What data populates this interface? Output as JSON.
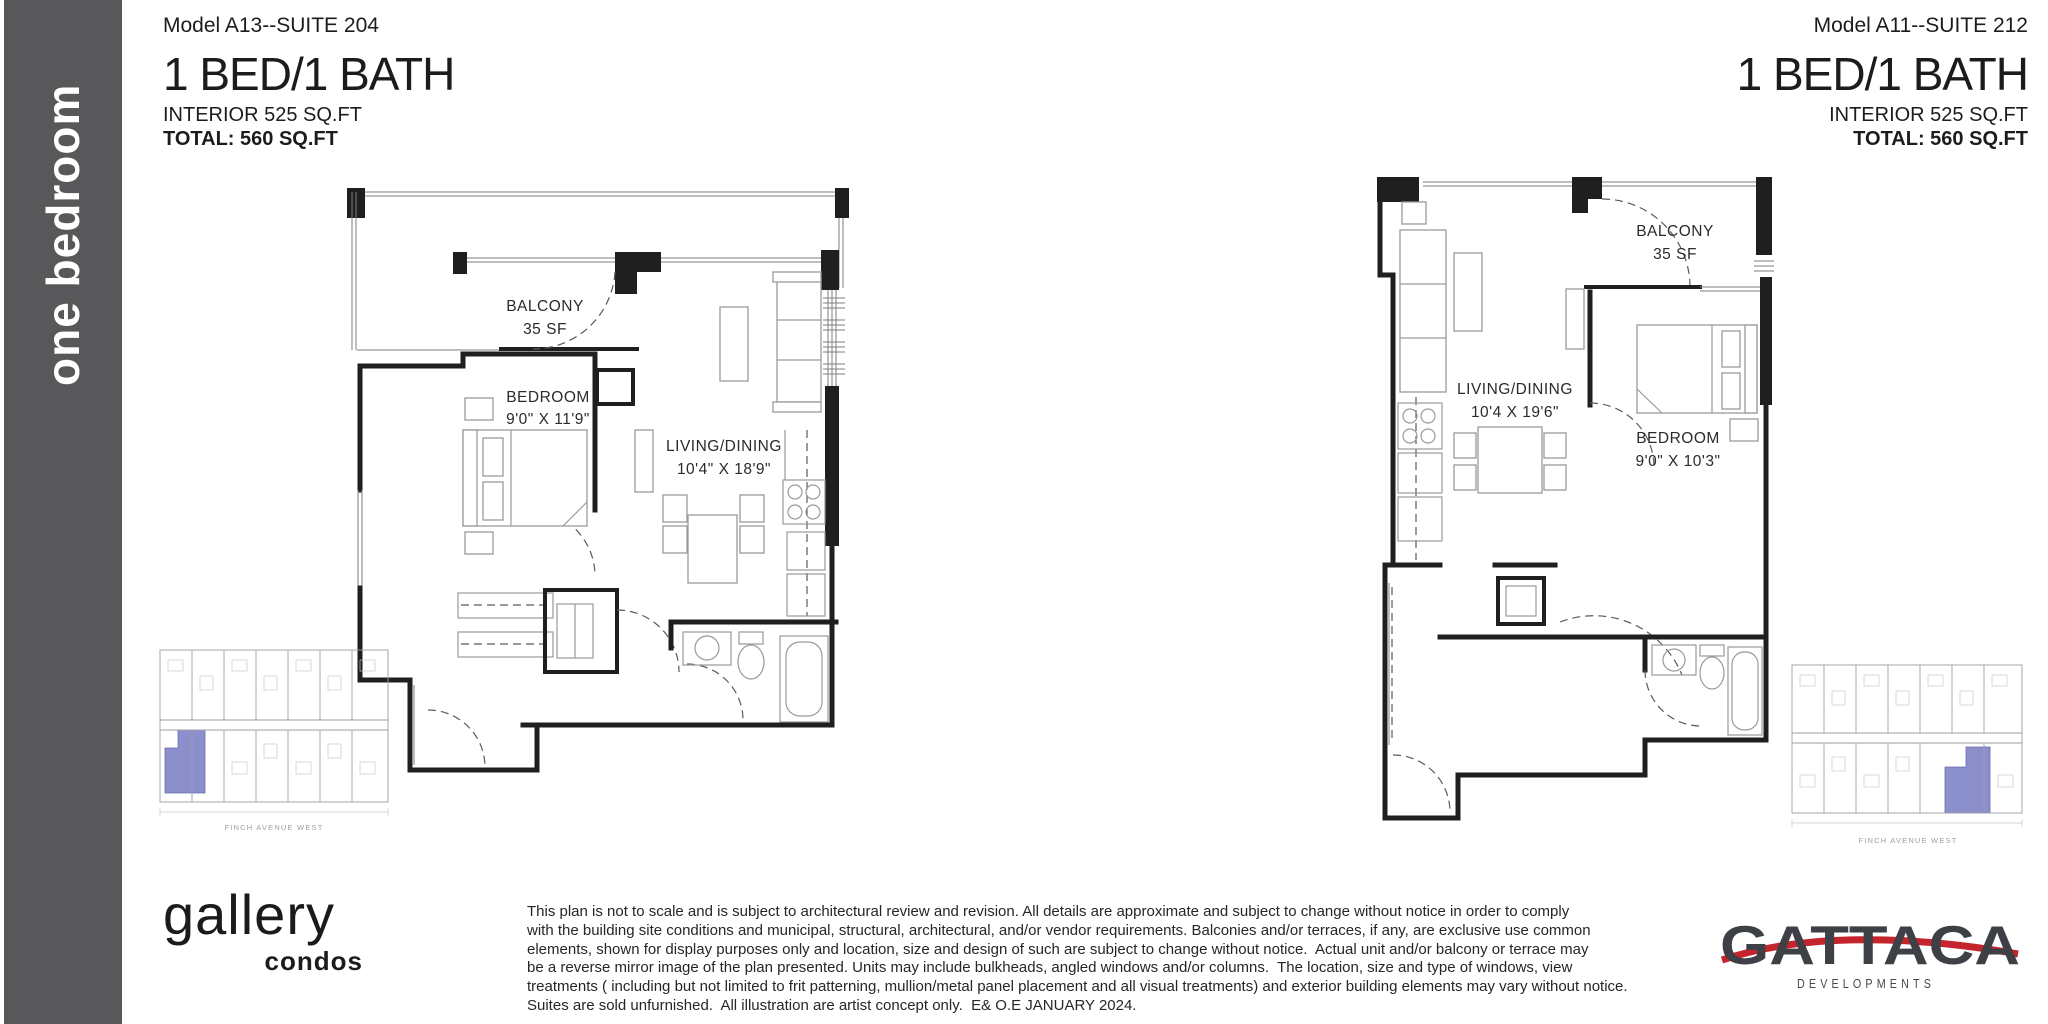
{
  "sidebar": {
    "label": "one bedroom"
  },
  "plans": [
    {
      "model": "Model A13--SUITE 204",
      "type": "1 BED/1 BATH",
      "interior": "INTERIOR 525 SQ.FT",
      "total": "TOTAL: 560 SQ.FT",
      "labels": {
        "balcony": "BALCONY",
        "balcony_area": "35 SF",
        "bedroom": "BEDROOM",
        "bedroom_dim": "9'0\" X 11'9\"",
        "living": "LIVING/DINING",
        "living_dim": "10'4\" X 18'9\""
      },
      "keyplan_caption": "FINCH AVENUE WEST"
    },
    {
      "model": "Model A11--SUITE 212",
      "type": "1 BED/1 BATH",
      "interior": "INTERIOR 525 SQ.FT",
      "total": "TOTAL: 560 SQ.FT",
      "labels": {
        "balcony": "BALCONY",
        "balcony_area": "35 SF",
        "bedroom": "BEDROOM",
        "bedroom_dim": "9'0\" X 10'3\"",
        "living": "LIVING/DINING",
        "living_dim": "10'4 X 19'6\""
      },
      "keyplan_caption": "FINCH AVENUE WEST"
    }
  ],
  "footer": {
    "brand": {
      "name": "gallery",
      "sub": "condos"
    },
    "disclaimer": {
      "lines": [
        "This plan is not to scale and is subject to architectural review and revision. All details are approximate and subject to change without notice in order to comply",
        "with the building site conditions and municipal, structural, architectural, and/or vendor requirements. Balconies and/or terraces, if any, are exclusive use common",
        "elements, shown for display purposes only and location, size and design of such are subject to change without notice.  Actual unit and/or balcony or terrace may",
        "be a reverse mirror image of the plan presented. Units may include bulkheads, angled windows and/or columns.  The location, size and type of windows, view",
        "treatments ( including but not limited to frit patterning, mullion/metal panel placement and all visual treatments) and exterior building elements may vary without notice.",
        "Suites are sold unfurnished.  All illustration are artist concept only.  E& O.E JANUARY 2024."
      ]
    },
    "developer": {
      "name": "GATTACA",
      "sub": "DEVELOPMENTS"
    }
  },
  "colors": {
    "sidebar_bg": "#58585a",
    "highlight_unit": "#8186c7",
    "developer_accent": "#c4242b",
    "wall": "#1f1f1f"
  }
}
